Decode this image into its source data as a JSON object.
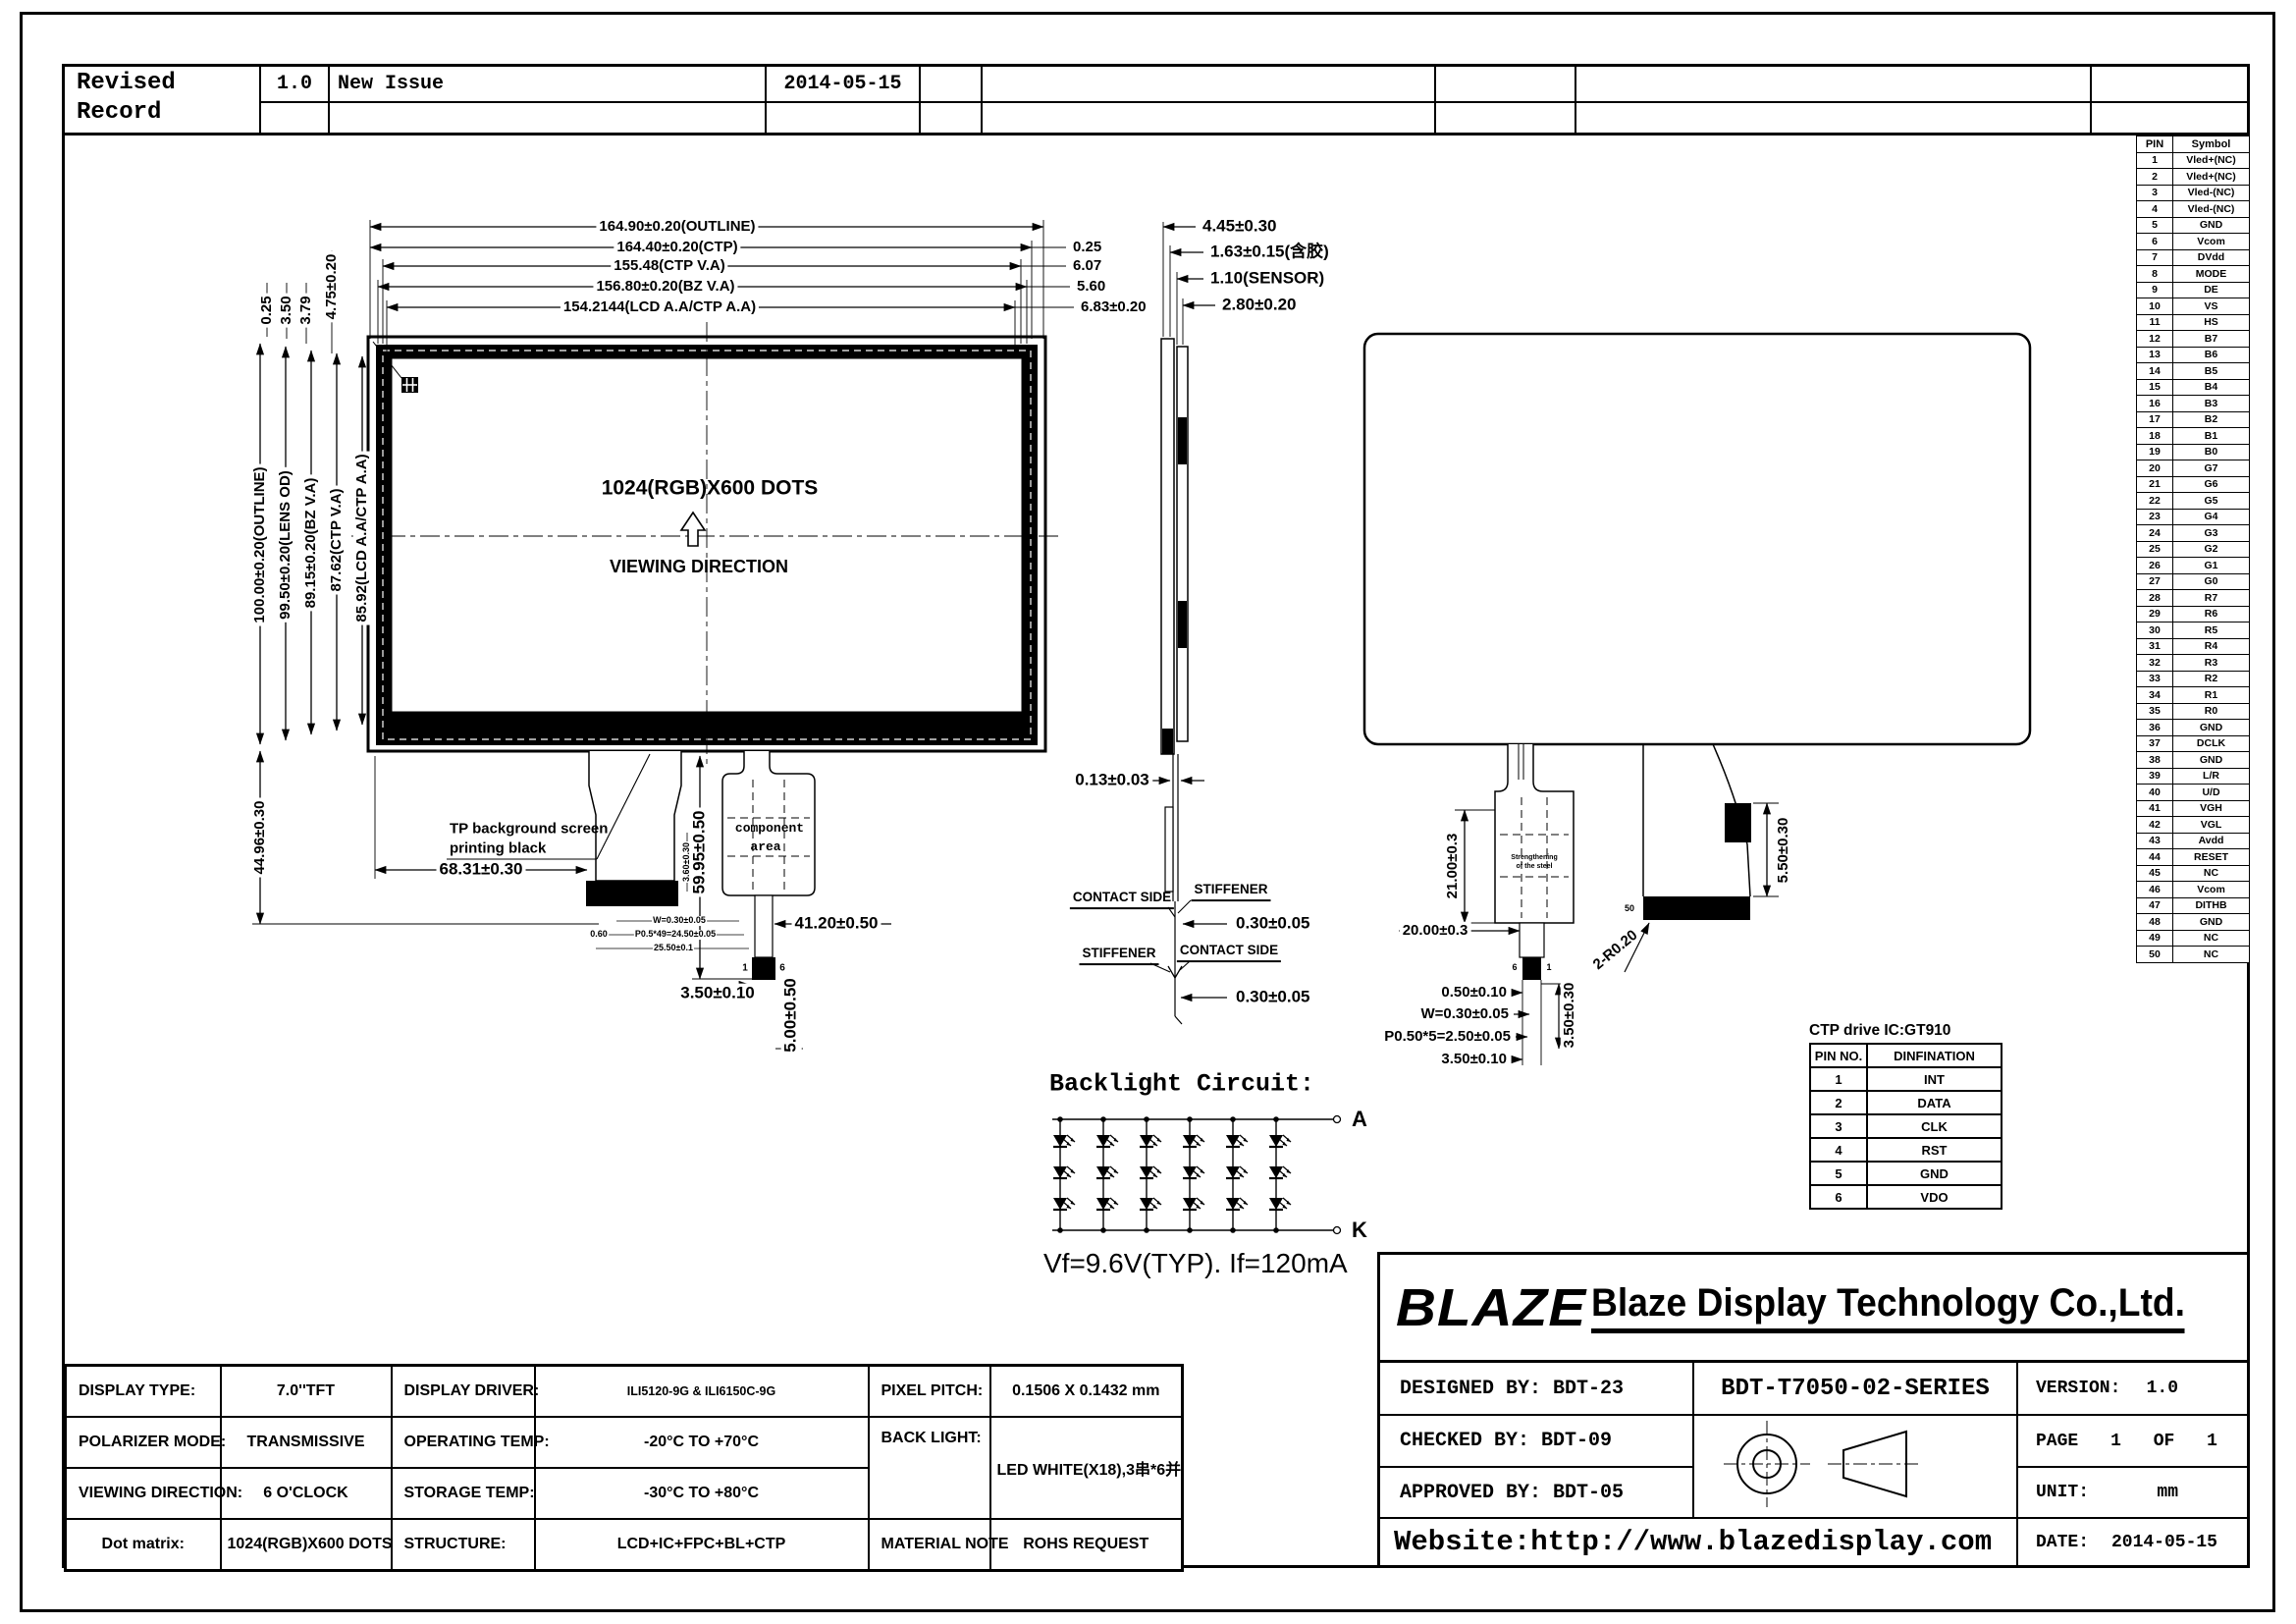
{
  "revision": {
    "title_line1": "Revised",
    "title_line2": "Record",
    "version": "1.0",
    "note": "New Issue",
    "date": "2014-05-15"
  },
  "pin_table": {
    "col_pin": "PIN",
    "col_symbol": "Symbol",
    "pins": [
      "Vled+(NC)",
      "Vled+(NC)",
      "Vled-(NC)",
      "Vled-(NC)",
      "GND",
      "Vcom",
      "DVdd",
      "MODE",
      "DE",
      "VS",
      "HS",
      "B7",
      "B6",
      "B5",
      "B4",
      "B3",
      "B2",
      "B1",
      "B0",
      "G7",
      "G6",
      "G5",
      "G4",
      "G3",
      "G2",
      "G1",
      "G0",
      "R7",
      "R6",
      "R5",
      "R4",
      "R3",
      "R2",
      "R1",
      "R0",
      "GND",
      "DCLK",
      "GND",
      "L/R",
      "U/D",
      "VGH",
      "VGL",
      "Avdd",
      "RESET",
      "NC",
      "Vcom",
      "DITHB",
      "GND",
      "NC",
      "NC"
    ]
  },
  "front_view": {
    "top_dims": [
      "164.90±0.20(OUTLINE)",
      "164.40±0.20(CTP)",
      "155.48(CTP V.A)",
      "156.80±0.20(BZ V.A)",
      "154.2144(LCD A.A/CTP A.A)"
    ],
    "right_dims": [
      "0.25",
      "6.07",
      "5.60",
      "6.83±0.20"
    ],
    "left_top_dims": [
      "0.25",
      "3.50",
      "3.79",
      "4.75±0.20"
    ],
    "left_dims": [
      "100.00±0.20(OUTLINE)",
      "99.50±0.20(LENS OD)",
      "89.15±0.20(BZ V.A)",
      "87.62(CTP V.A)",
      "85.92(LCD A.A/CTP A.A)"
    ],
    "bottom_left_dim": "44.96±0.30",
    "center_text": "1024(RGB)X600 DOTS",
    "viewing_direction": "VIEWING DIRECTION",
    "tp_note1": "TP background screen",
    "tp_note2": "printing black",
    "dim_fpc_offset": "68.31±0.30",
    "dim_fpc_len": "59.95±0.50",
    "dim_ctp_fpc": "41.20±0.50",
    "dim_conn_w": "3.50±0.10",
    "dim_conn_len": "5.00±0.50",
    "component_area1": "component",
    "component_area2": "area",
    "fpc_tiny_dims": [
      "W=0.30±0.05",
      "P0.5*49=24.50±0.05",
      "25.50±0.1"
    ],
    "fpc_tiny_left": "0.60",
    "fpc_tiny_vert": "3.60±0.30",
    "pin_first": "1",
    "pin_last": "6"
  },
  "side_view": {
    "top_dims": [
      "4.45±0.30",
      "1.63±0.15(含胶)",
      "1.10(SENSOR)",
      "2.80±0.20"
    ],
    "dim_thickness": "0.13±0.03",
    "contact_side": "CONTACT SIDE",
    "stiffener": "STIFFENER",
    "dim_stiffener_t": "0.30±0.05",
    "dim_stiffener_b": "0.30±0.05"
  },
  "back_view": {
    "dim_grid_h": "21.00±0.3",
    "dim_grid_w": "20.00±0.3",
    "dim_050": "0.50±0.10",
    "dim_w030": "W=0.30±0.05",
    "dim_pitch": "P0.50*5=2.50±0.05",
    "dim_350a": "3.50±0.10",
    "dim_350v": "3.50±0.30",
    "dim_r020": "2-R0.20",
    "dim_550": "5.50±0.30",
    "grid_note1": "Strengthening",
    "grid_note2": "of the steel",
    "pin_50": "50",
    "pin_6": "6",
    "pin_1": "1"
  },
  "backlight": {
    "title": "Backlight Circuit:",
    "anode": "A",
    "cathode": "K",
    "spec": "Vf=9.6V(TYP). If=120mA"
  },
  "ctp_table": {
    "title": "CTP drive IC:GT910",
    "col_pin": "PIN NO.",
    "col_def": "DINFINATION",
    "rows": [
      [
        "1",
        "INT"
      ],
      [
        "2",
        "DATA"
      ],
      [
        "3",
        "CLK"
      ],
      [
        "4",
        "RST"
      ],
      [
        "5",
        "GND"
      ],
      [
        "6",
        "VDO"
      ]
    ]
  },
  "spec": {
    "display_type_label": "DISPLAY TYPE:",
    "display_type": "7.0''TFT",
    "display_driver_label": "DISPLAY DRIVER:",
    "display_driver": "ILI5120-9G & ILI6150C-9G",
    "pixel_pitch_label": "PIXEL PITCH:",
    "pixel_pitch": "0.1506 X 0.1432 mm",
    "polarizer_label": "POLARIZER MODE:",
    "polarizer": "TRANSMISSIVE",
    "operating_label": "OPERATING TEMP:",
    "operating": "-20°C TO +70°C",
    "backlight_label": "BACK LIGHT:",
    "backlight": "LED WHITE(X18),3串*6并",
    "viewing_label": "VIEWING DIRECTION:",
    "viewing": "6 O'CLOCK",
    "storage_label": "STORAGE TEMP:",
    "storage": "-30°C TO +80°C",
    "dot_matrix_label": "Dot matrix:",
    "dot_matrix": "1024(RGB)X600 DOTS",
    "structure_label": "STRUCTURE:",
    "structure": "LCD+IC+FPC+BL+CTP",
    "material_label": "MATERIAL NOTE",
    "material": "ROHS REQUEST"
  },
  "title_block": {
    "logo": "BLAZE",
    "company": "Blaze Display Technology Co.,Ltd.",
    "designed": "DESIGNED BY: BDT-23",
    "checked": "CHECKED BY:  BDT-09",
    "approved": "APPROVED BY: BDT-05",
    "series": "BDT-T7050-02-SERIES",
    "version_label": "VERSION:",
    "version": "1.0",
    "page_label": "PAGE",
    "page": "1",
    "of_label": "OF",
    "of": "1",
    "unit_label": "UNIT:",
    "unit": "mm",
    "date_label": "DATE:",
    "date": "2014-05-15",
    "website": "Website:http://www.blazedisplay.com"
  }
}
